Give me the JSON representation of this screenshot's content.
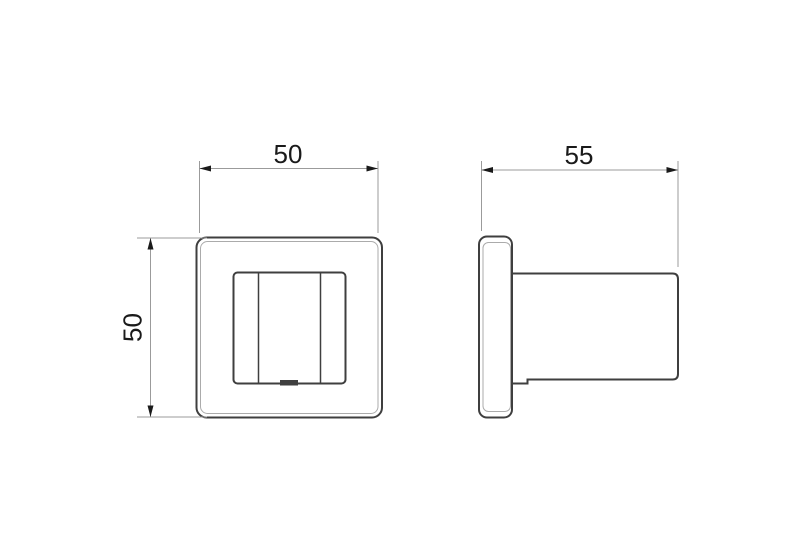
{
  "page": {
    "background": "#ffffff"
  },
  "drawing": {
    "views": {
      "front": {
        "name": "front-view",
        "dimensions": {
          "width": {
            "label": "50"
          },
          "height": {
            "label": "50"
          }
        }
      },
      "side": {
        "name": "side-view",
        "dimensions": {
          "depth": {
            "label": "55"
          }
        }
      }
    },
    "colors": {
      "object_outline": "#3f3f3f",
      "edge_contour": "#ababab",
      "dimension_line": "#9b9b9b",
      "label_text": "#1a1a1a",
      "background": "#ffffff"
    }
  }
}
